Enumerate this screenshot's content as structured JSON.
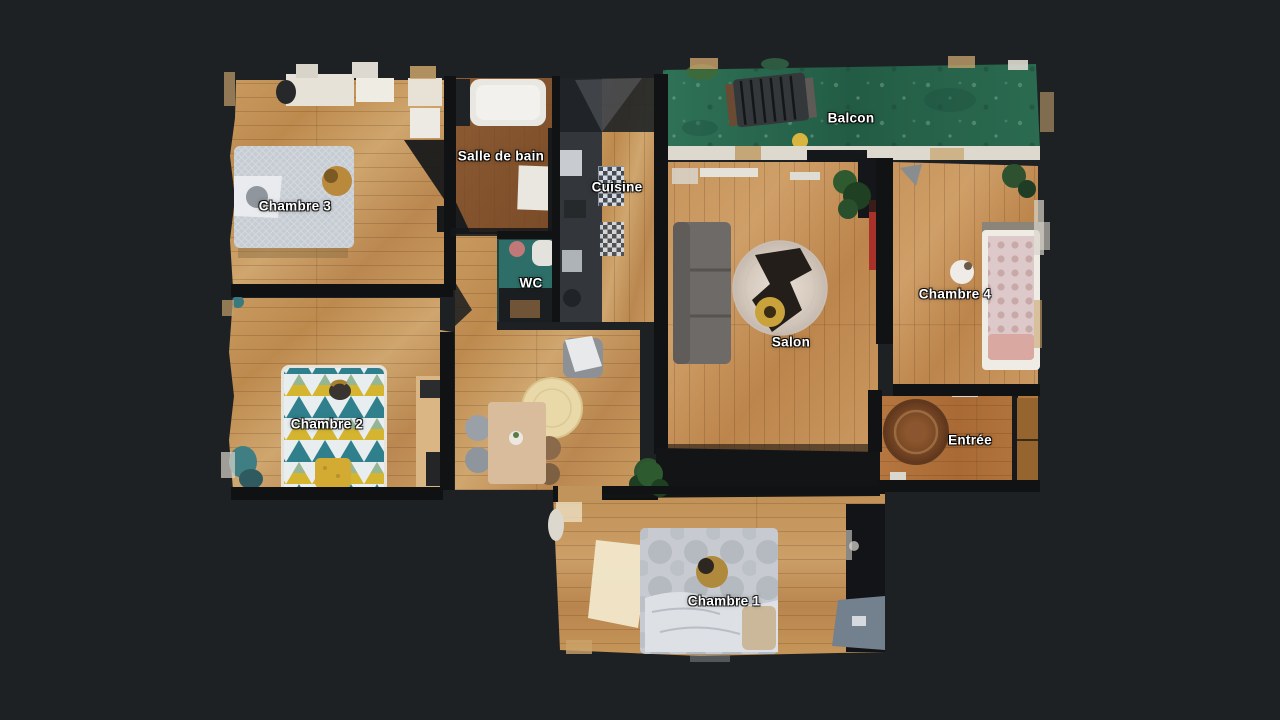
{
  "scene": {
    "type": "apartment-floorplan-top-view",
    "background_color": "#1e2124"
  },
  "colors": {
    "background": "#1e2124",
    "wood_floor": "#c89a60",
    "entry_floor": "#ad6d38",
    "bathroom_floor": "#8a5a33",
    "balcony_green": "#2a6b50",
    "walls": "#101214",
    "label_text": "#ffffff",
    "bed2_teal": "#2f7f8c",
    "bed2_yellow": "#d5b52f",
    "sofa_gray": "#6e6a67",
    "red_cabinet": "#a8322a"
  },
  "rooms": [
    {
      "id": "chambre-3",
      "label": "Chambre 3",
      "x": 295,
      "y": 206
    },
    {
      "id": "salle-de-bain",
      "label": "Salle de bain",
      "x": 501,
      "y": 156
    },
    {
      "id": "cuisine",
      "label": "Cuisine",
      "x": 617,
      "y": 187
    },
    {
      "id": "wc",
      "label": "WC",
      "x": 531,
      "y": 283
    },
    {
      "id": "chambre-2",
      "label": "Chambre 2",
      "x": 327,
      "y": 424
    },
    {
      "id": "balcon",
      "label": "Balcon",
      "x": 851,
      "y": 118
    },
    {
      "id": "salon",
      "label": "Salon",
      "x": 791,
      "y": 342
    },
    {
      "id": "chambre-4",
      "label": "Chambre 4",
      "x": 955,
      "y": 294
    },
    {
      "id": "entree",
      "label": "Entrée",
      "x": 970,
      "y": 440
    },
    {
      "id": "chambre-1",
      "label": "Chambre 1",
      "x": 724,
      "y": 601
    }
  ]
}
